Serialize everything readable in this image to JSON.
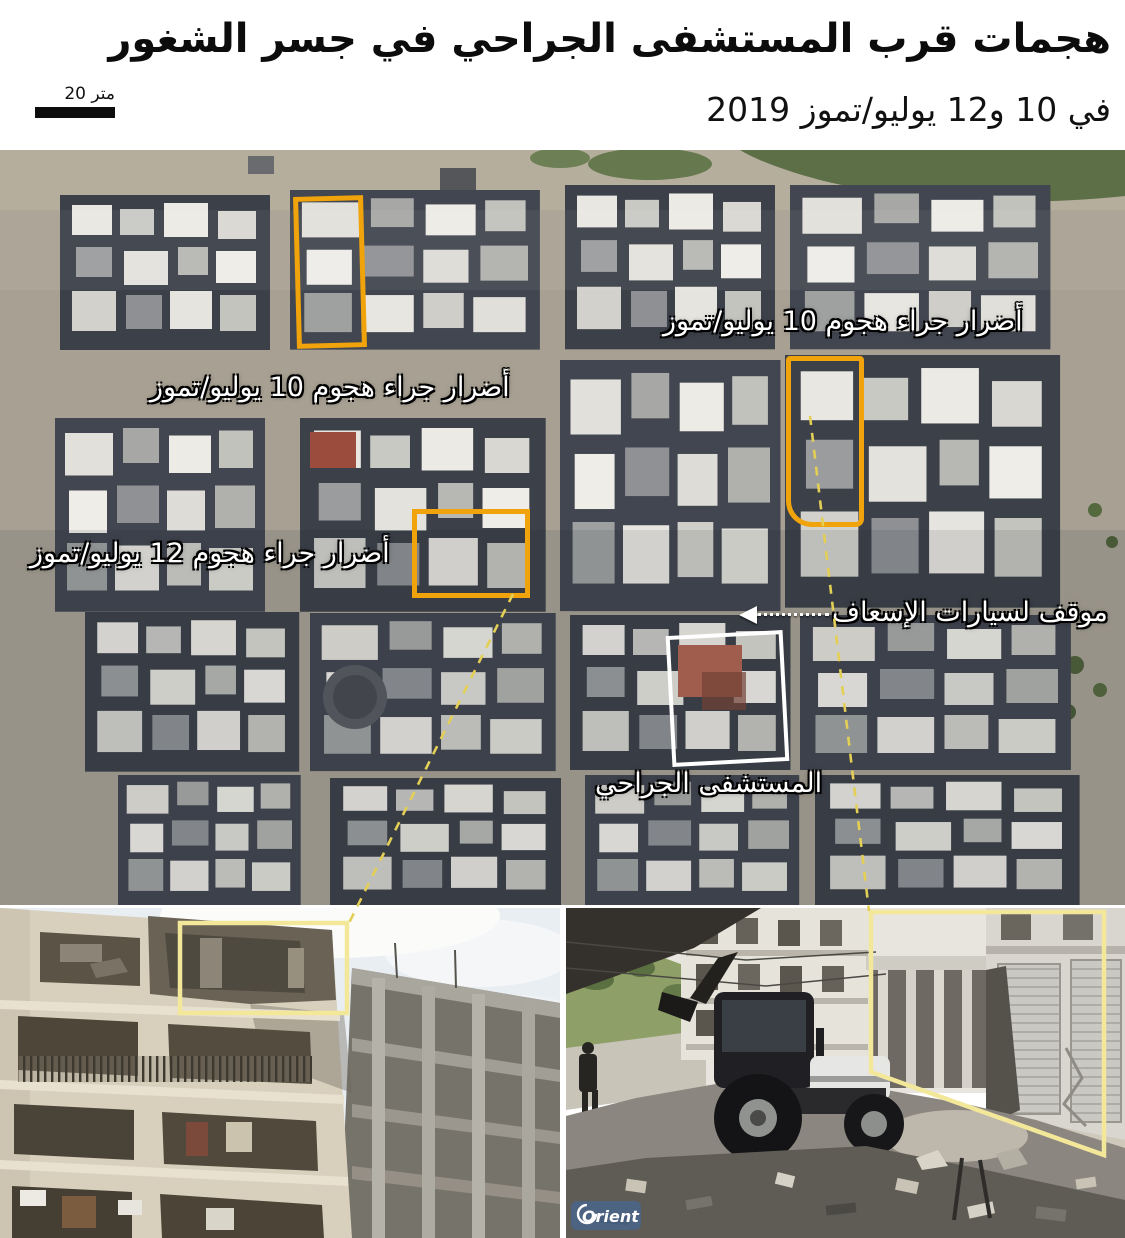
{
  "header": {
    "title_line1": "هجمات قرب المستشفى الجراحي في جسر الشغور",
    "title_line2": "في 10 و12 يوليو/تموز 2019",
    "scale_label": "20 متر"
  },
  "map": {
    "labels": {
      "damage_jul10_right": "أضرار جراء هجوم 10 يوليو/تموز",
      "damage_jul10_left": "أضرار جراء هجوم 10 يوليو/تموز",
      "damage_jul12": "أضرار جراء هجوم 12 يوليو/تموز",
      "ambulance_parking": "موقف لسيارات الإسعاف",
      "hospital": "المستشفى الجراحي"
    },
    "colors": {
      "damage_box": "#F0A30B",
      "hospital_box": "#FFFFFF",
      "photo_highlight": "#F3E79A",
      "connector_dash": "#E3CF55"
    }
  },
  "photos": {
    "right": {
      "watermark": "Orient"
    }
  }
}
